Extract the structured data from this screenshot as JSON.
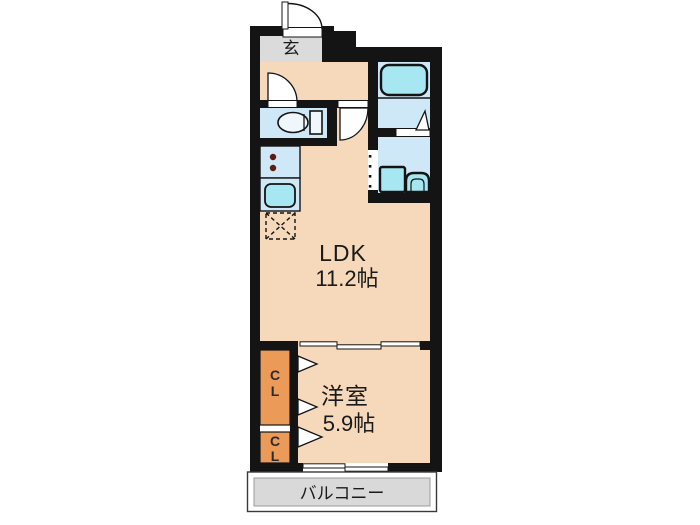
{
  "colors": {
    "wall": "#141414",
    "room_peach": "#F6D8BA",
    "wet_blue": "#CFE8F7",
    "fixture_cyan": "#A6E7F2",
    "fixture_light": "#EFF7FD",
    "closet_orange": "#EB9A57",
    "entry_gray": "#DBDBDB",
    "balcony_gray": "#D9D9D9",
    "burner": "#5E1B12",
    "text": "#1A1A1A"
  },
  "entrance": {
    "label": "玄"
  },
  "ldk": {
    "label": "LDK",
    "area": "11.2帖"
  },
  "bedroom": {
    "label": "洋室",
    "area": "5.9帖"
  },
  "balcony": {
    "label": "バルコニー"
  },
  "closets": {
    "upper": {
      "letter1": "C",
      "letter2": "L"
    },
    "lower": {
      "letter1": "C",
      "letter2": "L"
    }
  },
  "fixtures": {
    "bathtub": "bathtub",
    "toilet": "toilet",
    "washing_machine": "washing-machine-pan",
    "wash_basin": "wash-basin",
    "stove": "two-burner-stove",
    "sink": "kitchen-sink",
    "refrigerator": "refrigerator-space"
  }
}
